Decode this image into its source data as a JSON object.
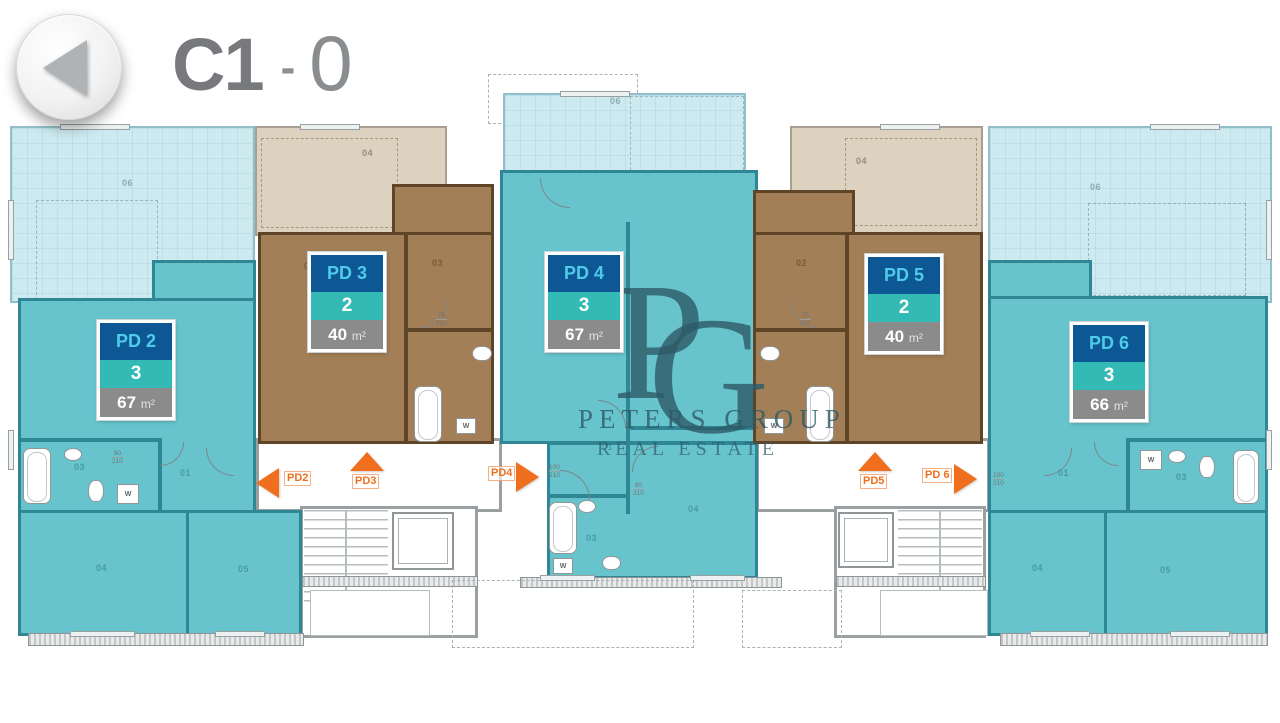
{
  "header": {
    "title_block": "C1",
    "title_dash": "-",
    "title_floor": "0"
  },
  "watermark": {
    "mono_p": "P",
    "mono_g": "G",
    "line1": "PETERS GROUP",
    "line2": "REAL ESTATE"
  },
  "units": [
    {
      "id": "PD2",
      "label": "PD 2",
      "rooms": "3",
      "area_value": "67",
      "area_unit": "m²"
    },
    {
      "id": "PD3",
      "label": "PD 3",
      "rooms": "2",
      "area_value": "40",
      "area_unit": "m²"
    },
    {
      "id": "PD4",
      "label": "PD 4",
      "rooms": "3",
      "area_value": "67",
      "area_unit": "m²"
    },
    {
      "id": "PD5",
      "label": "PD 5",
      "rooms": "2",
      "area_value": "40",
      "area_unit": "m²"
    },
    {
      "id": "PD6",
      "label": "PD 6",
      "rooms": "3",
      "area_value": "66",
      "area_unit": "m²"
    }
  ],
  "arrows": [
    {
      "label": "PD2",
      "direction": "left"
    },
    {
      "label": "PD3",
      "direction": "up"
    },
    {
      "label": "PD4",
      "direction": "right"
    },
    {
      "label": "PD5",
      "direction": "up"
    },
    {
      "label": "PD 6",
      "direction": "right"
    }
  ],
  "plan": {
    "washer": "W",
    "room_labels": [
      {
        "text": "06"
      },
      {
        "text": "04"
      },
      {
        "text": "06"
      },
      {
        "text": "04"
      },
      {
        "text": "06"
      },
      {
        "text": "03"
      },
      {
        "text": "01"
      },
      {
        "text": "04"
      },
      {
        "text": "05"
      },
      {
        "text": "02"
      },
      {
        "text": "03"
      },
      {
        "text": "01"
      },
      {
        "text": "03"
      },
      {
        "text": "04"
      },
      {
        "text": "02"
      },
      {
        "text": "01"
      },
      {
        "text": "03"
      },
      {
        "text": "04"
      },
      {
        "text": "05"
      }
    ],
    "dim_labels": [
      {
        "w": "90",
        "h": "210"
      },
      {
        "w": "75",
        "h": "210"
      },
      {
        "w": "100",
        "h": "210"
      },
      {
        "w": "80",
        "h": "210"
      },
      {
        "w": "75",
        "h": "210"
      },
      {
        "w": "100",
        "h": "210"
      }
    ]
  },
  "colors": {
    "accent_orange": "#f06f1e",
    "badge_blue": "#0d5795",
    "badge_label_cyan": "#4fcbe9",
    "badge_teal": "#33bab5",
    "badge_gray": "#8b8b8b",
    "apartment_teal": "#67c4cd",
    "terrace_cyan": "#cdeaf0",
    "apartment_brown": "#a27f56",
    "terrace_beige": "#ddd2bf",
    "watermark_slate": "#2d5a66",
    "title_gray": "#77797c"
  }
}
